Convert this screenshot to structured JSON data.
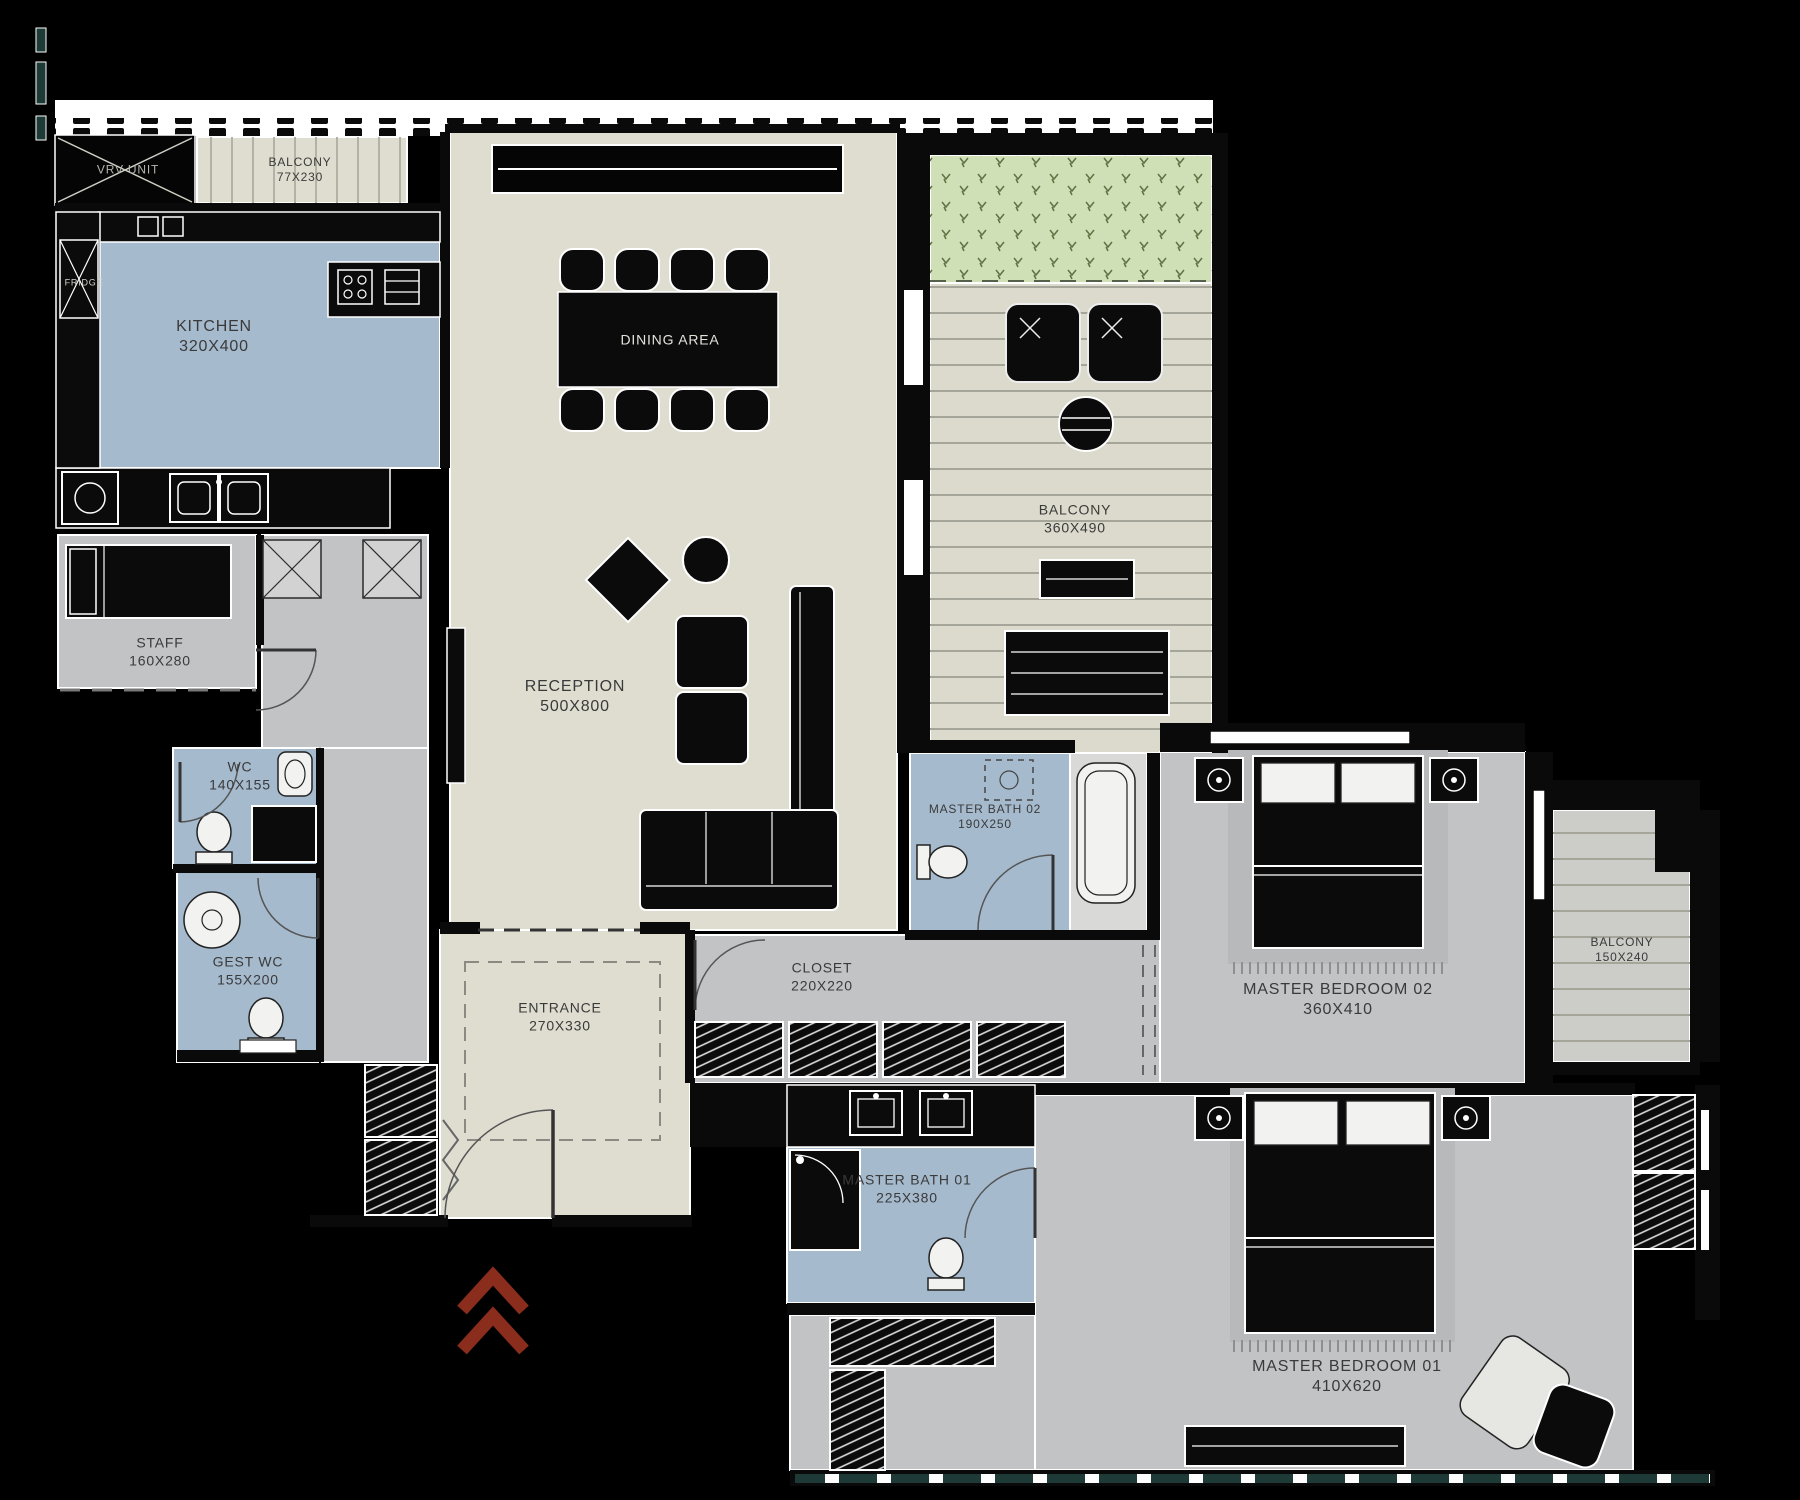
{
  "plan_title": "Apartment Floor Plan",
  "colors": {
    "beige": "#dfddd0",
    "gray": "#c2c3c5",
    "blue": "#a6bacd",
    "green": "#cfe0b6",
    "deck": "#dcdacc",
    "deck2": "#cccdc9",
    "wall": "#0a0a0a",
    "white": "#ffffff",
    "label": "#3a3a3a",
    "red": "#8a2d1c",
    "teal": "#1d3a36",
    "shaft": "#d2d2d2",
    "rug": "#b8b9bb",
    "fixture": "#f2f2f0"
  },
  "rooms": [
    {
      "key": "vrv-unit",
      "name": "VRV UNIT",
      "dims": ""
    },
    {
      "key": "balcony-top",
      "name": "BALCONY",
      "dims": "77X230"
    },
    {
      "key": "kitchen",
      "name": "KITCHEN",
      "dims": "320X400"
    },
    {
      "key": "fridge",
      "name": "FRIDGE",
      "dims": ""
    },
    {
      "key": "dining-area",
      "name": "DINING AREA",
      "dims": ""
    },
    {
      "key": "reception",
      "name": "RECEPTION",
      "dims": "500X800"
    },
    {
      "key": "staff",
      "name": "STAFF",
      "dims": "160X280"
    },
    {
      "key": "wc",
      "name": "WC",
      "dims": "140X155"
    },
    {
      "key": "gest-wc",
      "name": "GEST WC",
      "dims": "155X200"
    },
    {
      "key": "balcony-main",
      "name": "BALCONY",
      "dims": "360X490"
    },
    {
      "key": "master-bath-02",
      "name": "MASTER BATH 02",
      "dims": "190X250"
    },
    {
      "key": "closet",
      "name": "CLOSET",
      "dims": "220X220"
    },
    {
      "key": "entrance",
      "name": "ENTRANCE",
      "dims": "270X330"
    },
    {
      "key": "master-bedroom-02",
      "name": "MASTER BEDROOM 02",
      "dims": "360X410"
    },
    {
      "key": "balcony-right",
      "name": "BALCONY",
      "dims": "150X240"
    },
    {
      "key": "master-bath-01",
      "name": "MASTER BATH 01",
      "dims": "225X380"
    },
    {
      "key": "master-bedroom-01",
      "name": "MASTER BEDROOM 01",
      "dims": "410X620"
    }
  ]
}
